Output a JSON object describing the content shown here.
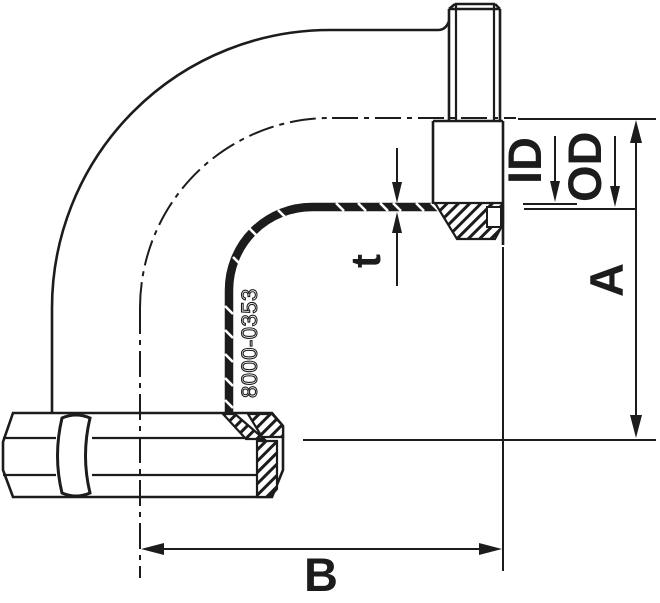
{
  "drawing": {
    "type": "technical-drawing-pipe-elbow-90deg",
    "part_number": "8000-0353",
    "labels": {
      "inner_diameter": "ID",
      "outer_diameter": "OD",
      "wall_thickness": "t",
      "height_a": "A",
      "length_b": "B"
    },
    "colors": {
      "ink": "#1c1c1c",
      "background": "#ffffff"
    }
  }
}
